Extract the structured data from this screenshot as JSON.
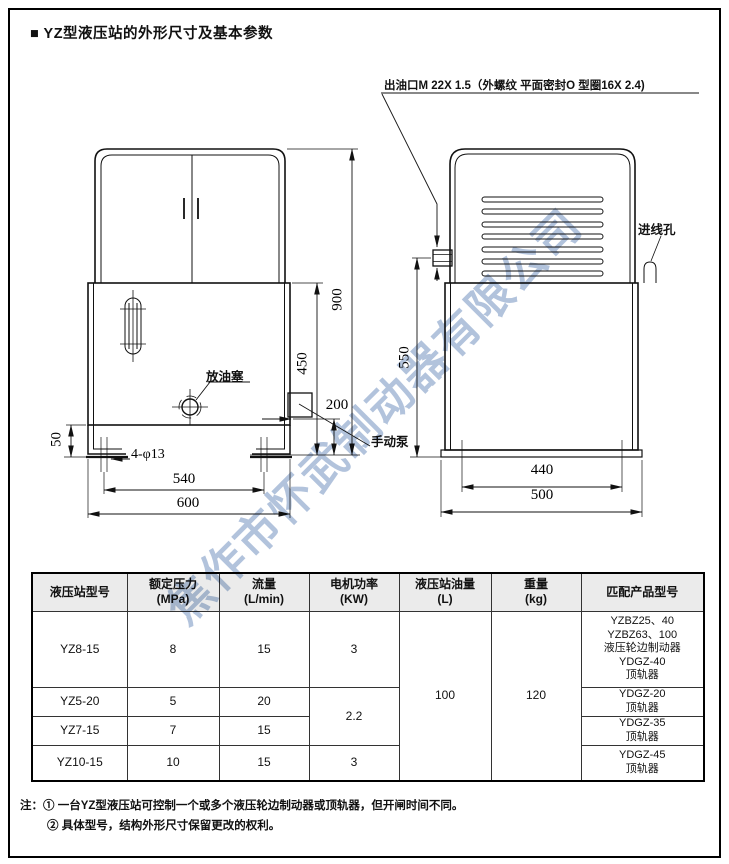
{
  "title": "■ YZ型液压站的外形尺寸及基本参数",
  "drawing": {
    "outlet_note": "出油口M 22X 1.5（外螺纹 平面密封O 型圈16X 2.4)",
    "labels": {
      "drain_plug": "放油塞",
      "hand_pump": "手动泵",
      "cable_hole": "进线孔",
      "mount_holes": "4-φ13"
    },
    "dims": {
      "total_height": "900",
      "tank_height": "450",
      "pump_height": "200",
      "foot_height": "50",
      "hole_span": "540",
      "overall_width": "600",
      "side_height": "550",
      "base_span": "440",
      "overall_depth": "500"
    }
  },
  "watermark": "焦作市怀武制动器有限公司",
  "table": {
    "headers": [
      {
        "label": "液压站型号",
        "unit": ""
      },
      {
        "label": "额定压力",
        "unit": "(MPa)"
      },
      {
        "label": "流量",
        "unit": "(L/min)"
      },
      {
        "label": "电机功率",
        "unit": "(KW)"
      },
      {
        "label": "液压站油量",
        "unit": "(L)"
      },
      {
        "label": "重量",
        "unit": "(kg)"
      },
      {
        "label": "匹配产品型号",
        "unit": ""
      }
    ],
    "shared": {
      "oil": "100",
      "weight": "120"
    },
    "rows": [
      {
        "model": "YZ8-15",
        "pressure": "8",
        "flow": "15",
        "power": "3",
        "match": [
          "YZBZ25、40",
          "YZBZ63、100",
          "液压轮边制动器",
          "YDGZ-40",
          "顶轨器"
        ]
      },
      {
        "model": "YZ5-20",
        "pressure": "5",
        "flow": "20",
        "power": "2.2",
        "match": [
          "YDGZ-20",
          "顶轨器"
        ]
      },
      {
        "model": "YZ7-15",
        "pressure": "7",
        "flow": "15",
        "match": [
          "YDGZ-35",
          "顶轨器"
        ]
      },
      {
        "model": "YZ10-15",
        "pressure": "10",
        "flow": "15",
        "power": "3",
        "match": [
          "YDGZ-45",
          "顶轨器"
        ]
      }
    ]
  },
  "notes": {
    "prefix": "注：",
    "items": [
      "① 一台YZ型液压站可控制一个或多个液压轮边制动器或顶轨器，但开闸时间不同。",
      "② 具体型号，结构外形尺寸保留更改的权利。"
    ]
  }
}
